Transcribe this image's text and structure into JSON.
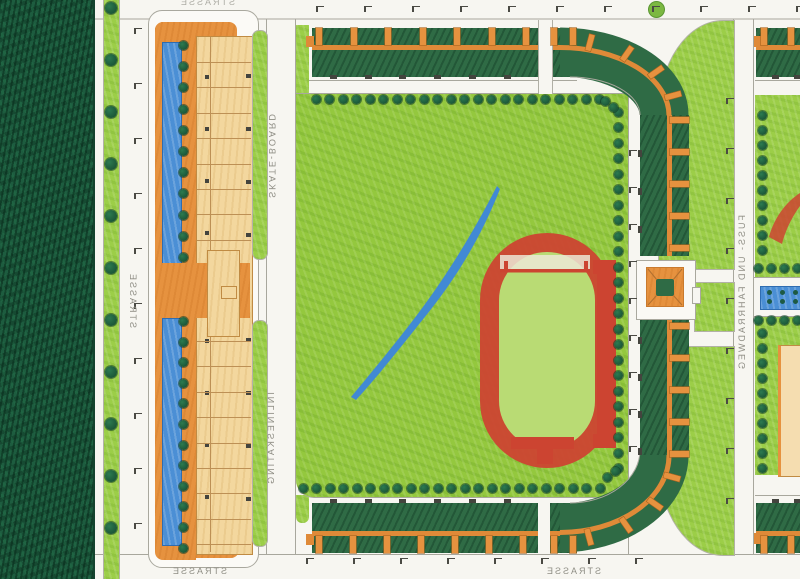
{
  "plan": {
    "type": "hand-drawn landscape architecture site plan (mirrored scan)",
    "labels": {
      "street_top": "STRASSE",
      "street_left": "STRASSE",
      "street_bottom_west": "STRASSE",
      "street_bottom_center": "STRASSE",
      "path_skate": "SKATE-BOARD",
      "path_inline": "INLINESKATING",
      "path_bike": "FUSS- UND FAHRRADWEG"
    },
    "colors": {
      "paper": "#f7f6f1",
      "line": "#a8a79d",
      "forest": "#1d5c3f",
      "lawn": "#9cce48",
      "field": "#94c83e",
      "infield": "#b9db74",
      "hedge": "#2f6b45",
      "tree": "#1b5537",
      "orange": "#e6923f",
      "orangeline": "#df8a38",
      "tan": "#f3d79e",
      "blue": "#4b8fd5",
      "red": "#cc4431",
      "label": "#8f8e85"
    },
    "icons": {
      "tree-icon": "filled dark-green circle",
      "street-lamp-icon": "small L-shaped hook",
      "entrance-mark": "small dark square",
      "house-block": "orange rectangle",
      "pond-dot-icon": "small dark teal circle"
    }
  }
}
